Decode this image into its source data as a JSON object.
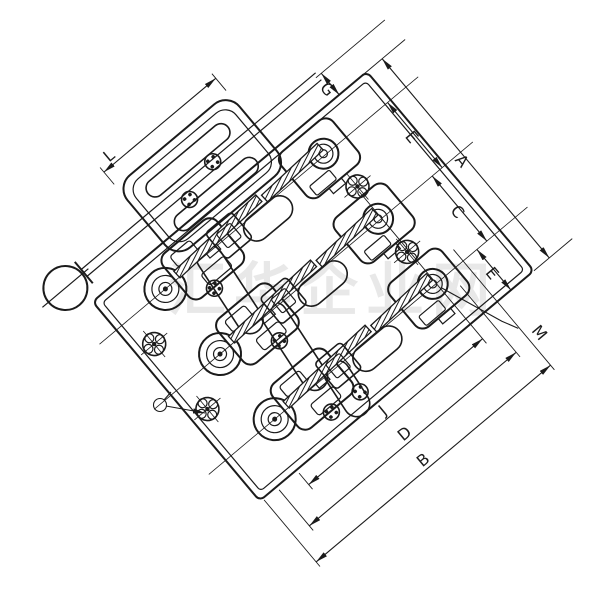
{
  "drawing": {
    "watermark": "汇华企业网",
    "dimensions": {
      "l": "L",
      "g": "G",
      "e1": "E",
      "c": "C",
      "e2": "E",
      "a": "A",
      "m": "M",
      "j": "J",
      "d": "D",
      "b": "B"
    },
    "colors": {
      "line": "#1b1b1b",
      "background": "#ffffff",
      "watermark": "#d6d6d6"
    }
  }
}
